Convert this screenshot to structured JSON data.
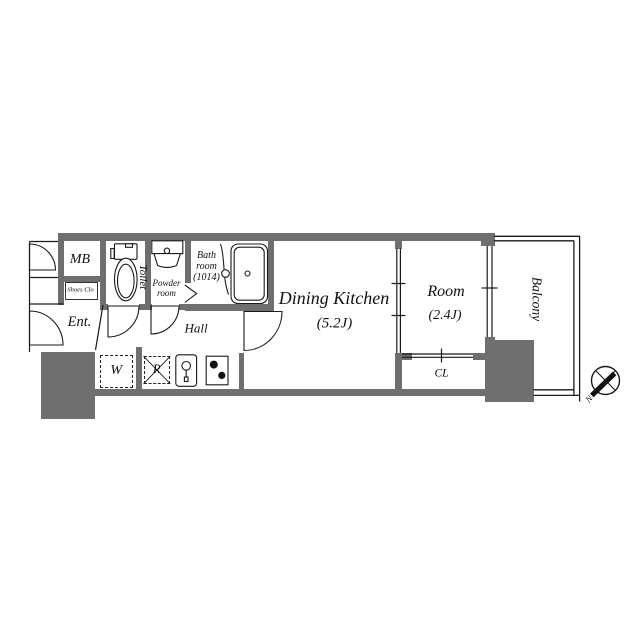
{
  "floor_plan": {
    "labels": {
      "mb": "MB",
      "shoes_closet": "Shoes Clo",
      "entrance": "Ent.",
      "toilet": "Toilet",
      "powder_line1": "Powder",
      "powder_line2": "room",
      "bath_line1": "Bath",
      "bath_line2": "room",
      "bath_line3": "(1014)",
      "hall": "Hall",
      "dining_kitchen": "Dining Kitchen",
      "dining_kitchen_size": "(5.2J)",
      "room": "Room",
      "room_size": "(2.4J)",
      "closet": "CL",
      "balcony": "Balcony",
      "washer": "W",
      "refrigerator": "R"
    },
    "compass": {
      "north_label": "N",
      "needle_direction": "southwest"
    },
    "fixtures": [
      "toilet",
      "washbasin",
      "bathtub",
      "bifold-bath-door",
      "kitchen-sink",
      "stove",
      "washing-machine",
      "refrigerator"
    ],
    "colors": {
      "wall_fill": "#6f6f6f",
      "line": "#1a1a1a",
      "background": "#ffffff"
    }
  }
}
